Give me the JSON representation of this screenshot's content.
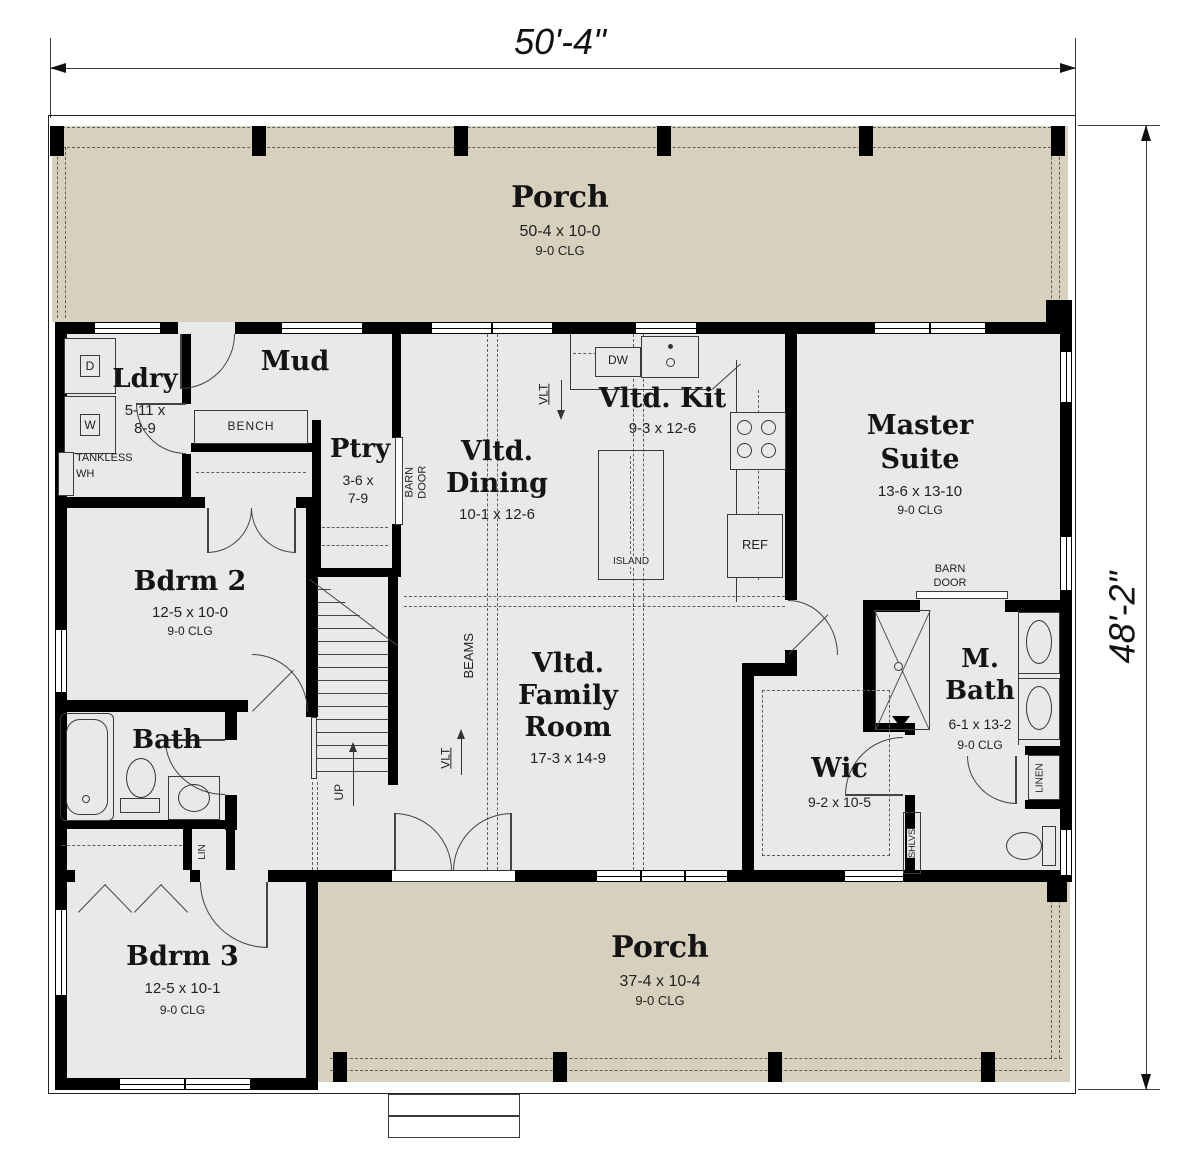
{
  "colors": {
    "porch": "#d7d0bd",
    "floor": "#e9e9e9",
    "wall": "#000000"
  },
  "dimensions": {
    "width_label": "50'-4\"",
    "height_label": "48'-2\""
  },
  "rooms": {
    "porch_top": {
      "name": "Porch",
      "size": "50-4 x 10-0",
      "clg": "9-0 CLG"
    },
    "mud": {
      "name": "Mud"
    },
    "ldry": {
      "name": "Ldry",
      "size1": "5-11 x",
      "size2": "8-9"
    },
    "ptry": {
      "name": "Ptry",
      "size1": "3-6 x",
      "size2": "7-9"
    },
    "dining": {
      "name1": "Vltd.",
      "name2": "Dining",
      "size": "10-1 x 12-6"
    },
    "kitchen": {
      "name": "Vltd. Kit",
      "size": "9-3 x 12-6"
    },
    "master": {
      "name1": "Master",
      "name2": "Suite",
      "size": "13-6 x 13-10",
      "clg": "9-0 CLG"
    },
    "bdrm2": {
      "name": "Bdrm 2",
      "size": "12-5 x 10-0",
      "clg": "9-0 CLG"
    },
    "family": {
      "name1": "Vltd.",
      "name2": "Family",
      "name3": "Room",
      "size": "17-3 x 14-9"
    },
    "bath": {
      "name": "Bath"
    },
    "wic": {
      "name": "Wic",
      "size": "9-2 x 10-5"
    },
    "mbath": {
      "name1": "M.",
      "name2": "Bath",
      "size": "6-1 x 13-2",
      "clg": "9-0 CLG"
    },
    "bdrm3": {
      "name": "Bdrm 3",
      "size": "12-5 x 10-1",
      "clg": "9-0 CLG"
    },
    "porch_bottom": {
      "name": "Porch",
      "size": "37-4 x 10-4",
      "clg": "9-0 CLG"
    }
  },
  "labels": {
    "bench": "BENCH",
    "tankless1": "TANKLESS",
    "tankless2": "WH",
    "dryer": "D",
    "washer": "W",
    "dw": "DW",
    "island": "ISLAND",
    "ref": "REF",
    "barn1": "BARN",
    "barn2": "DOOR",
    "vlt": "VLT",
    "beams": "BEAMS",
    "up": "UP",
    "lin": "LIN",
    "linen": "LINEN",
    "shlvs": "SHLVS"
  }
}
